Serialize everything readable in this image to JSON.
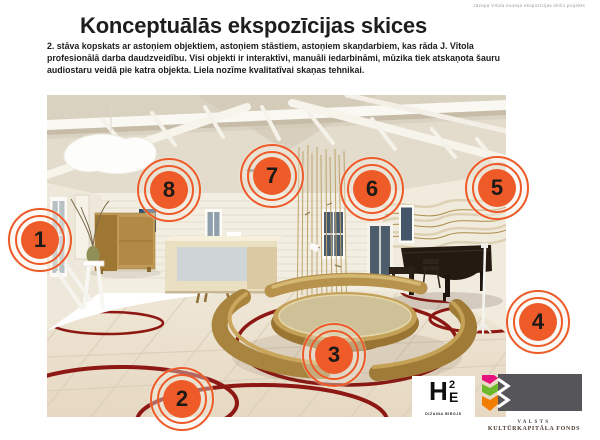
{
  "slide": {
    "corner_note": "Jāzepa Vītola muzeja ekspozīcijas skiču projekts",
    "title": "Konceptuālās ekspozīcijas skices",
    "description": "2. stāva kopskats ar astoņiem objektiem, astoņiem stāstiem, astoņiem skaņdarbiem, kas rāda J. Vītola profesionālā darba daudzveidību. Visi objekti ir interaktīvi, manuāli iedarbināmi, mūzika tiek atskaņota šauru audiostaru veidā pie katra objekta. Liela nozīme kvalitatīvai skaņas tehnikai."
  },
  "markers": [
    {
      "number": "1"
    },
    {
      "number": "2"
    },
    {
      "number": "3"
    },
    {
      "number": "4"
    },
    {
      "number": "5"
    },
    {
      "number": "6"
    },
    {
      "number": "7"
    },
    {
      "number": "8"
    }
  ],
  "logos": {
    "h2e": {
      "letter_h": "H",
      "letter_2": "2",
      "letter_e": "E",
      "caption": "DIZAINA BIROJS"
    },
    "vkkf": {
      "line1": "VALSTS",
      "line2": "KULTŪRKAPITĀLA FONDS"
    }
  },
  "colors": {
    "marker_orange": "#ee5a28",
    "floor_ring_red": "#8d1712",
    "vkkf_pink": "#e6127d",
    "vkkf_green": "#6eb92b",
    "vkkf_orange": "#f07d00",
    "vkkf_gray": "#55555a"
  }
}
